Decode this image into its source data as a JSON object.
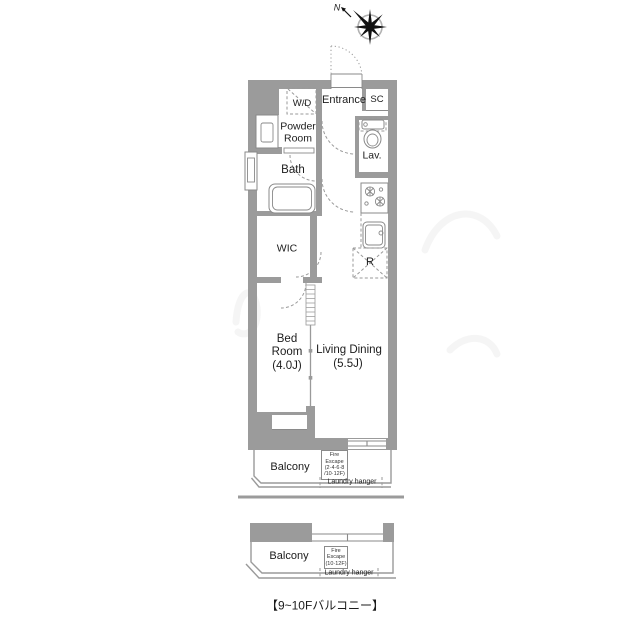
{
  "compass": {
    "north_label": "N"
  },
  "plan": {
    "rooms": {
      "wd": "W/D",
      "entrance": "Entrance",
      "shoe_closet": "SC",
      "powder_line1": "Powder",
      "powder_line2": "Room",
      "lavatory": "Lav.",
      "bath": "Bath",
      "wic": "WIC",
      "bed_line1": "Bed",
      "bed_line2": "Room",
      "bed_size": "(4.0J)",
      "living_dining": "Living Dining",
      "living_dining_size": "(5.5J)",
      "refrigerator": "R"
    },
    "balcony": {
      "label": "Balcony",
      "fire_escape_lines": [
        "Fire",
        "Escape",
        "(2·4·6·8",
        "/10·12F)"
      ],
      "laundry_hanger": "Laundry hanger"
    }
  },
  "sub_balcony": {
    "label": "Balcony",
    "fire_escape_lines": [
      "Fire",
      "Escape",
      "(10·12F)"
    ],
    "laundry_hanger": "Laundry hanger",
    "caption": "【9~10Fバルコニー】"
  },
  "colors": {
    "wall": "#9b9b9b",
    "fixture_line": "#8a8a8a",
    "text": "#1c1c1c"
  }
}
